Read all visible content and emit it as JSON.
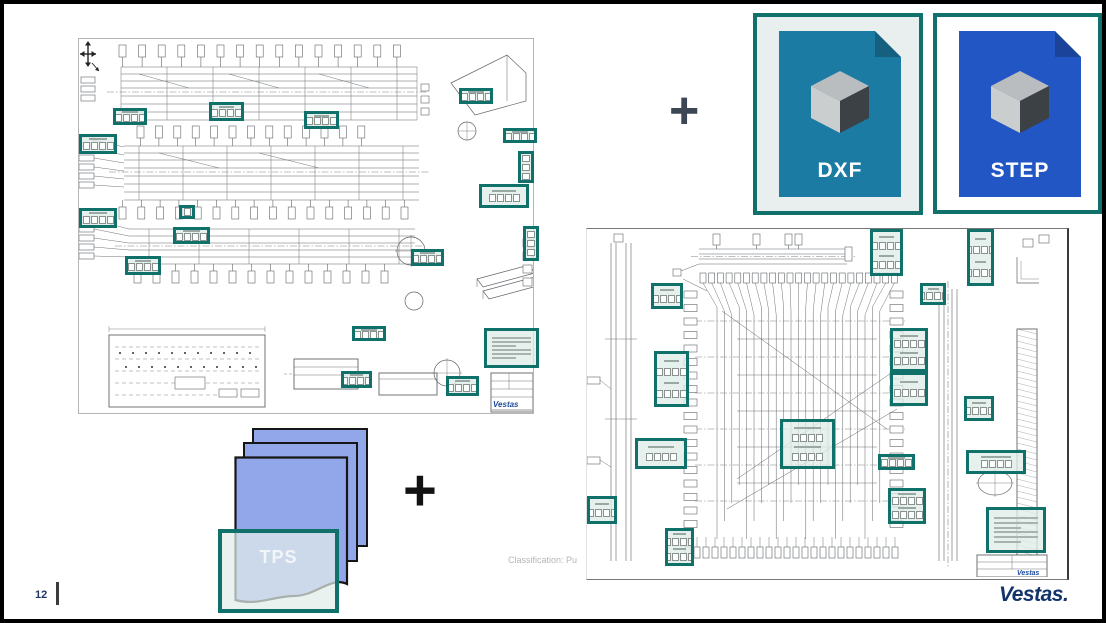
{
  "slide": {
    "page_number": "12",
    "classification_text": "Classification: Pu",
    "brand_logo": "Vestas."
  },
  "plus_top": "+",
  "plus_bottom": "+",
  "file_cards": [
    {
      "label": "DXF"
    },
    {
      "label": "STEP"
    }
  ],
  "tps_card": {
    "label": "TPS"
  },
  "left_drawing": {
    "title_block_logo": "Vestas",
    "highlights": [
      {
        "x": 34,
        "y": 69,
        "w": 34,
        "h": 17
      },
      {
        "x": 130,
        "y": 63,
        "w": 35,
        "h": 19
      },
      {
        "x": 225,
        "y": 72,
        "w": 35,
        "h": 18
      },
      {
        "x": 0,
        "y": 95,
        "w": 38,
        "h": 20
      },
      {
        "x": 0,
        "y": 169,
        "w": 38,
        "h": 20
      },
      {
        "x": 100,
        "y": 166,
        "w": 16,
        "h": 14,
        "t": "small"
      },
      {
        "x": 94,
        "y": 188,
        "w": 37,
        "h": 17
      },
      {
        "x": 46,
        "y": 217,
        "w": 36,
        "h": 19
      },
      {
        "x": 380,
        "y": 49,
        "w": 34,
        "h": 16
      },
      {
        "x": 424,
        "y": 89,
        "w": 34,
        "h": 15
      },
      {
        "x": 439,
        "y": 112,
        "w": 16,
        "h": 32,
        "t": "tall"
      },
      {
        "x": 400,
        "y": 145,
        "w": 50,
        "h": 24
      },
      {
        "x": 444,
        "y": 187,
        "w": 16,
        "h": 35,
        "t": "tall"
      },
      {
        "x": 332,
        "y": 210,
        "w": 33,
        "h": 17
      },
      {
        "x": 273,
        "y": 287,
        "w": 34,
        "h": 15
      },
      {
        "x": 262,
        "y": 332,
        "w": 31,
        "h": 17
      },
      {
        "x": 367,
        "y": 337,
        "w": 33,
        "h": 20
      },
      {
        "x": 405,
        "y": 289,
        "w": 55,
        "h": 40,
        "t": "notes"
      }
    ]
  },
  "right_drawing": {
    "title_block_logo": "Vestas",
    "highlights": [
      {
        "x": 64,
        "y": 54,
        "w": 32,
        "h": 26
      },
      {
        "x": 67,
        "y": 122,
        "w": 35,
        "h": 56,
        "t": "double"
      },
      {
        "x": 283,
        "y": 0,
        "w": 33,
        "h": 47,
        "t": "double"
      },
      {
        "x": 380,
        "y": 0,
        "w": 27,
        "h": 57,
        "t": "double"
      },
      {
        "x": 333,
        "y": 54,
        "w": 26,
        "h": 22
      },
      {
        "x": 303,
        "y": 99,
        "w": 38,
        "h": 44,
        "t": "double"
      },
      {
        "x": 303,
        "y": 143,
        "w": 38,
        "h": 34
      },
      {
        "x": 377,
        "y": 167,
        "w": 30,
        "h": 25
      },
      {
        "x": 193,
        "y": 190,
        "w": 55,
        "h": 50,
        "t": "double"
      },
      {
        "x": 291,
        "y": 225,
        "w": 37,
        "h": 16
      },
      {
        "x": 301,
        "y": 259,
        "w": 38,
        "h": 36,
        "t": "double"
      },
      {
        "x": 379,
        "y": 221,
        "w": 60,
        "h": 24
      },
      {
        "x": 399,
        "y": 278,
        "w": 60,
        "h": 46,
        "t": "notes"
      },
      {
        "x": 48,
        "y": 209,
        "w": 52,
        "h": 31
      },
      {
        "x": 0,
        "y": 267,
        "w": 30,
        "h": 28
      },
      {
        "x": 78,
        "y": 299,
        "w": 29,
        "h": 38,
        "t": "double"
      }
    ]
  },
  "colors": {
    "highlight_teal": "#0f716a",
    "dxf_doc_blue": "#1b7ba3",
    "step_doc_blue": "#2256c5",
    "dxf_card_bg": "#e9efee",
    "tps_page_blue": "#92a7e9",
    "brand_navy": "#13336b",
    "plus_dark": "#3d4654"
  }
}
